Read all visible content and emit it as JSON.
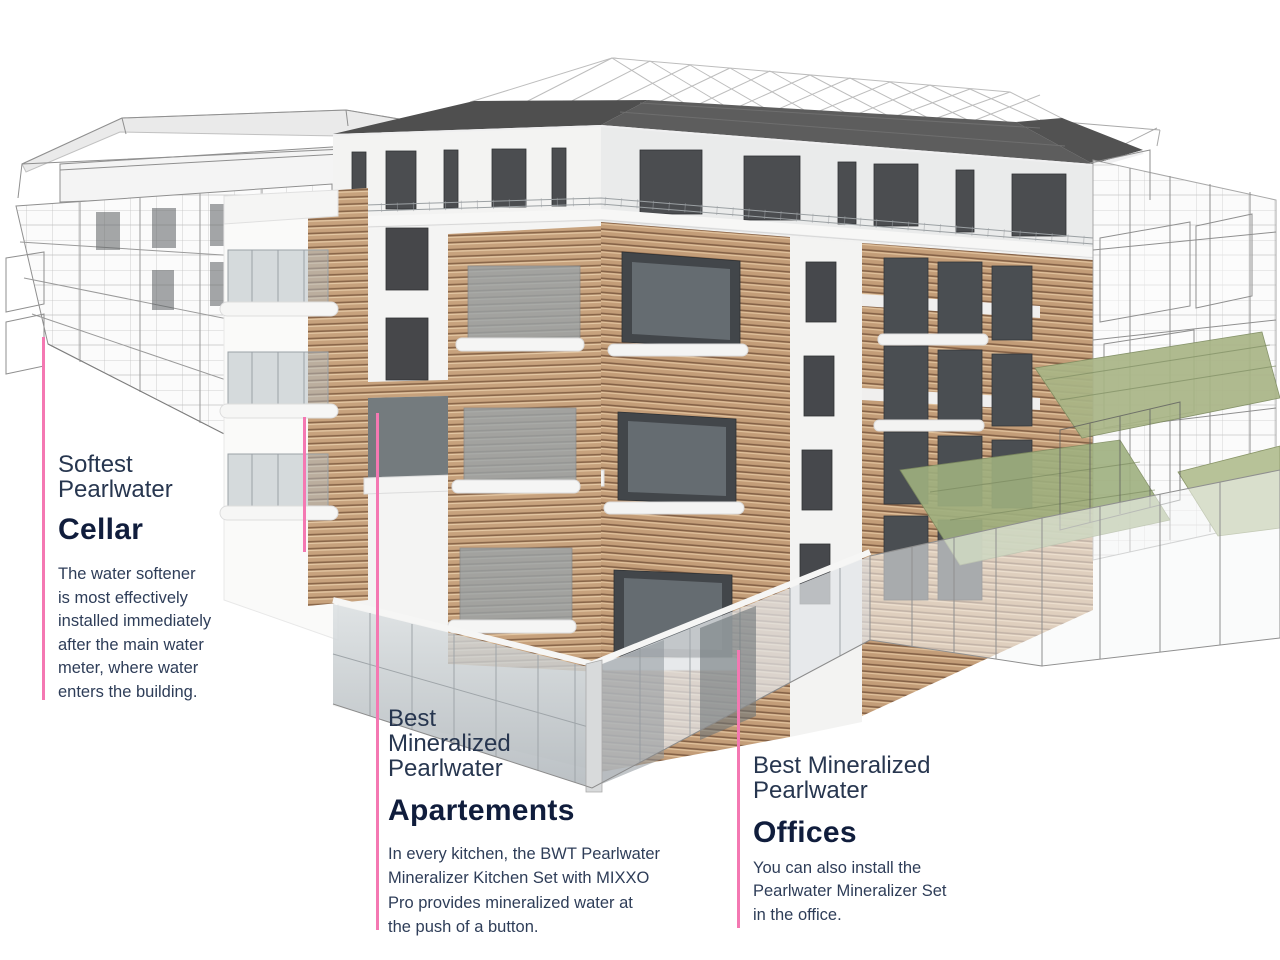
{
  "colors": {
    "accent_pink": "#f478b2",
    "title_navy": "#101d3c",
    "subtitle_navy": "#27364f",
    "body_navy": "#2e3d58",
    "background": "#ffffff",
    "roof_gray": "#565656",
    "wood_tan": "#c7a27d",
    "terrace_green": "#a3b183"
  },
  "annotations": {
    "cellar": {
      "subtitle": "Softest\nPearlwater",
      "title": "Cellar",
      "body": "The water softener\nis most effectively\ninstalled immediately\nafter the main water\nmeter, where water\nenters the building."
    },
    "apartments": {
      "subtitle": "Best\nMineralized\nPearlwater",
      "title": "Apartements",
      "body": "In every kitchen, the BWT Pearlwater\nMineralizer Kitchen Set with MIXXO\nPro provides mineralized water at\nthe push of a button."
    },
    "offices": {
      "subtitle": "Best Mineralized\nPearlwater",
      "title": "Offices",
      "body": "You can also install the\nPearlwater Mineralizer Set\nin the office."
    }
  }
}
